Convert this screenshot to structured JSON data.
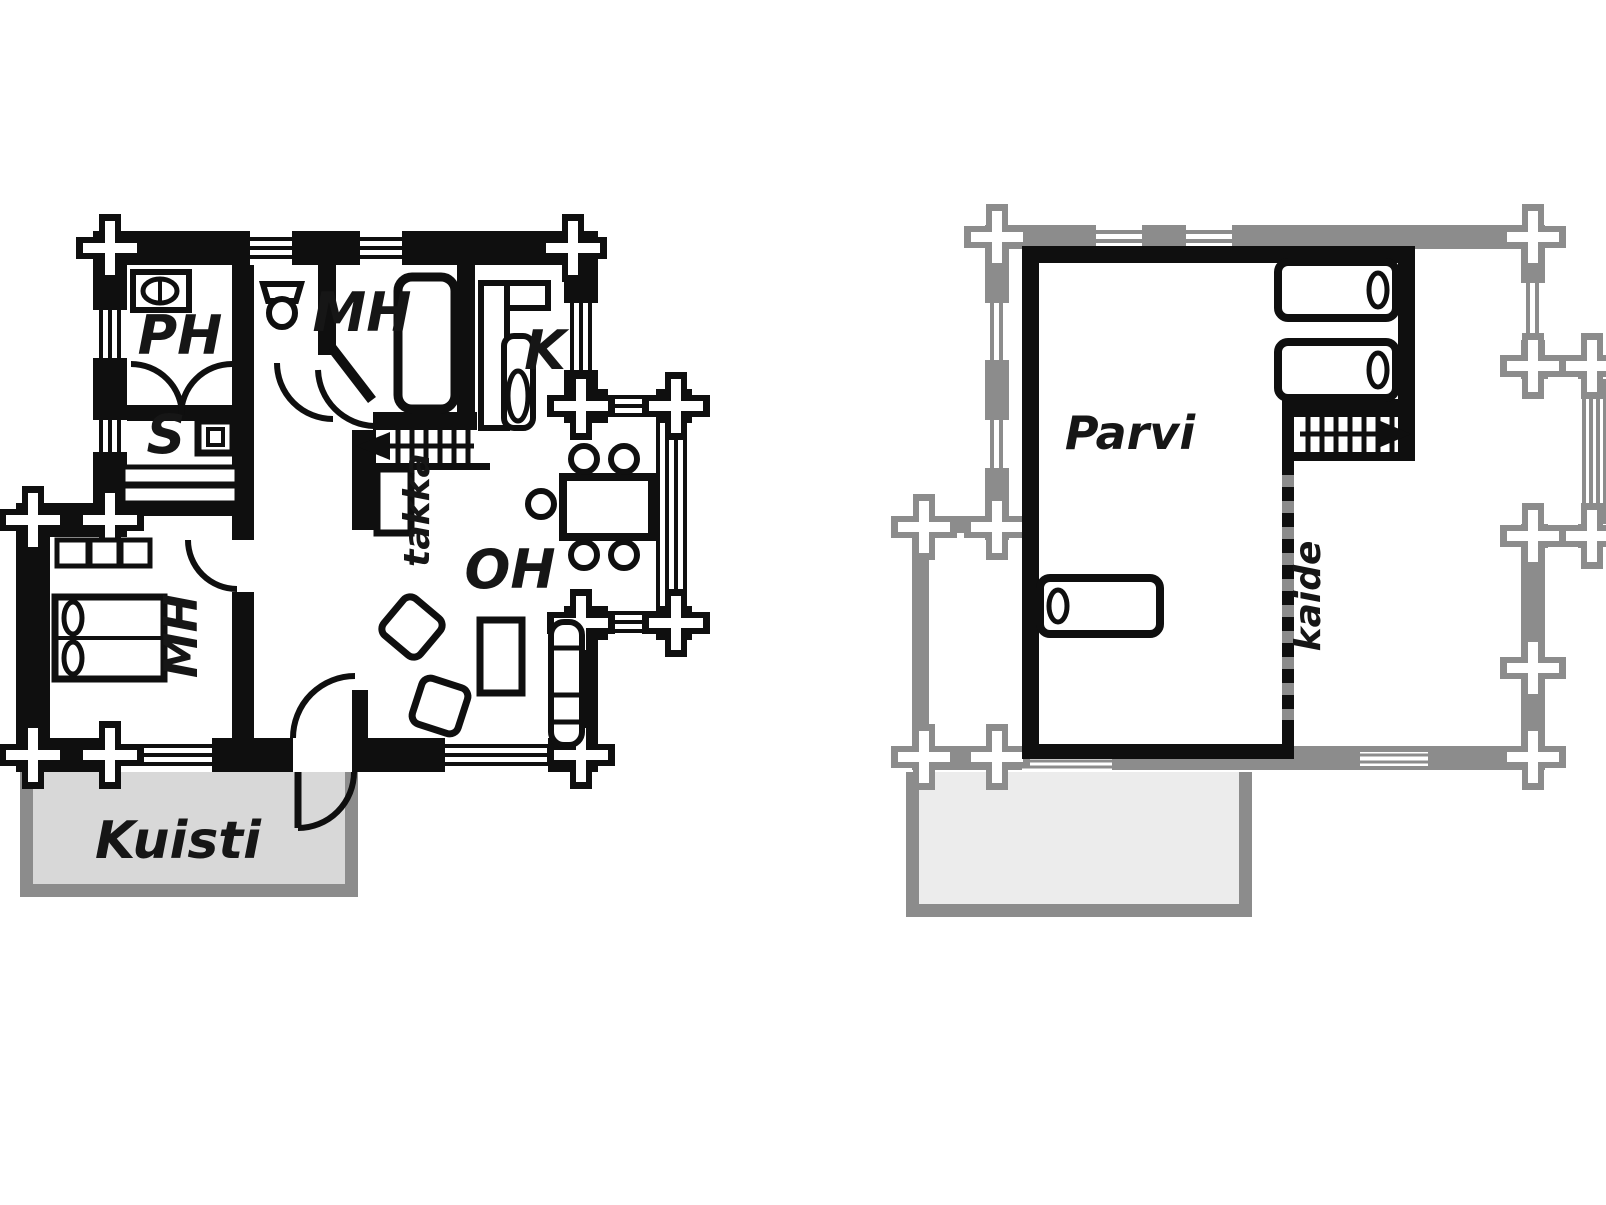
{
  "document": {
    "kind": "cottage floor plan drawing",
    "floors": [
      "ground floor",
      "upper floor"
    ]
  },
  "colors": {
    "ink": "#0f0f0f",
    "lower_outline_gray": "#8c8c8c",
    "ground_porch_fill": "#d8d8d8",
    "upper_porch_fill": "#ececec",
    "background": "#ffffff"
  },
  "ground_floor": {
    "labels": {
      "washroom": "PH",
      "sauna": "S",
      "wc": "",
      "bedroom_top": "MH",
      "kitchen": "K",
      "living_room": "OH",
      "fireplace": "takka",
      "bedroom_side": "MH",
      "porch": "Kuisti"
    }
  },
  "upper_floor": {
    "labels": {
      "loft": "Parvi",
      "railing": "kaide"
    }
  }
}
